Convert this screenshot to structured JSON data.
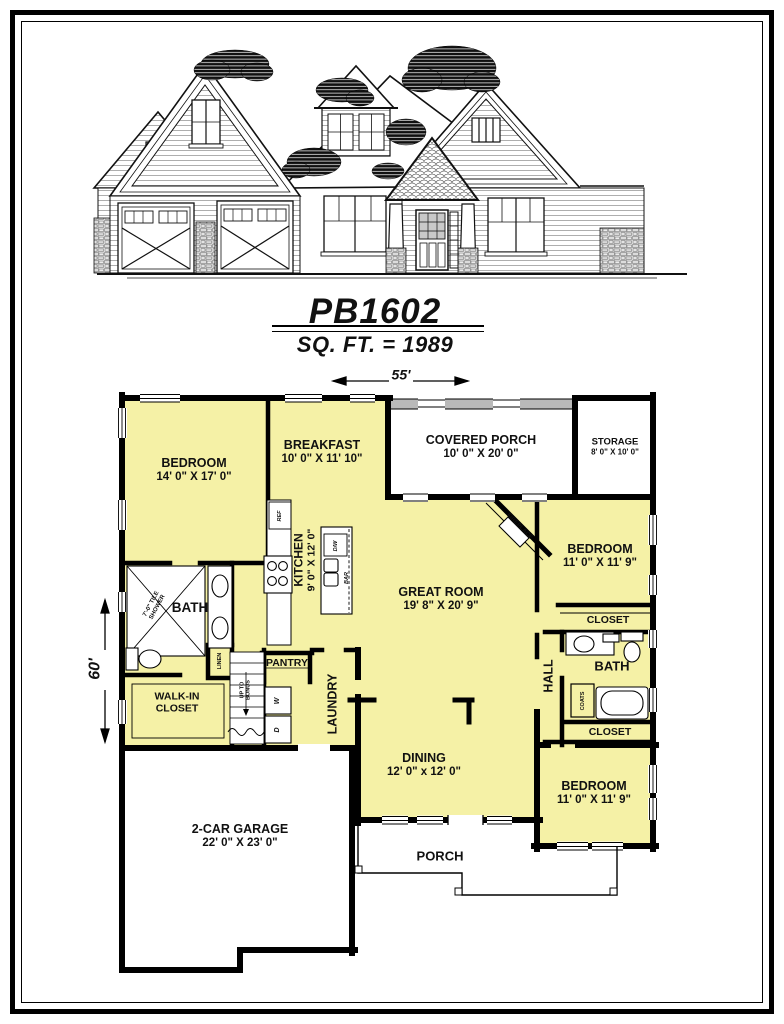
{
  "title_block": {
    "plan_number": "PB1602",
    "sqft_line": "SQ. FT. = 1989"
  },
  "dimensions": {
    "overall_width": "55'",
    "overall_depth": "60'"
  },
  "rooms": {
    "bedroom_master": {
      "name": "BEDROOM",
      "dims": "14' 0\" X 17' 0\""
    },
    "breakfast": {
      "name": "BREAKFAST",
      "dims": "10' 0\" X 11' 10\""
    },
    "covered_porch": {
      "name": "COVERED PORCH",
      "dims": "10' 0\" X 20' 0\""
    },
    "storage": {
      "name": "STORAGE",
      "dims": "8' 0\" X 10' 0\""
    },
    "kitchen": {
      "name": "KITCHEN",
      "dims": "9' 0\" X 12' 0\""
    },
    "great_room": {
      "name": "GREAT ROOM",
      "dims": "19' 8\" X 20' 9\""
    },
    "bedroom_2": {
      "name": "BEDROOM",
      "dims": "11' 0\" X 11' 9\""
    },
    "bedroom_3": {
      "name": "BEDROOM",
      "dims": "11' 0\" X 11' 9\""
    },
    "dining": {
      "name": "DINING",
      "dims": "12' 0\" x 12' 0\""
    },
    "garage": {
      "name": "2-CAR GARAGE",
      "dims": "22' 0\" X 23' 0\""
    },
    "porch": {
      "name": "PORCH"
    },
    "bath_left": {
      "name": "BATH"
    },
    "bath_right": {
      "name": "BATH"
    },
    "walk_in_closet": {
      "line1": "WALK-IN",
      "line2": "CLOSET"
    },
    "pantry": {
      "name": "PANTRY"
    },
    "laundry": {
      "name": "LAUNDRY"
    },
    "hall": {
      "name": "HALL"
    },
    "closet_upper": {
      "name": "CLOSET"
    },
    "closet_lower": {
      "name": "CLOSET"
    }
  },
  "fixtures": {
    "fireplace": "FIREPLACE",
    "shower_line1": "7'-0\" TILE",
    "shower_line2": "SHOWER",
    "linen": "LINEN",
    "coats": "COATS",
    "refrigerator": "REF",
    "dishwasher": "D/W",
    "bar": "BAR",
    "washer": "W",
    "dryer": "D",
    "stairs_line1": "UP TO",
    "stairs_line2": "BONUS"
  },
  "colors": {
    "room_fill": "#F5F1A6",
    "wall": "#000000",
    "porch_screen": "#B9B9B9",
    "background": "#FFFFFF"
  }
}
